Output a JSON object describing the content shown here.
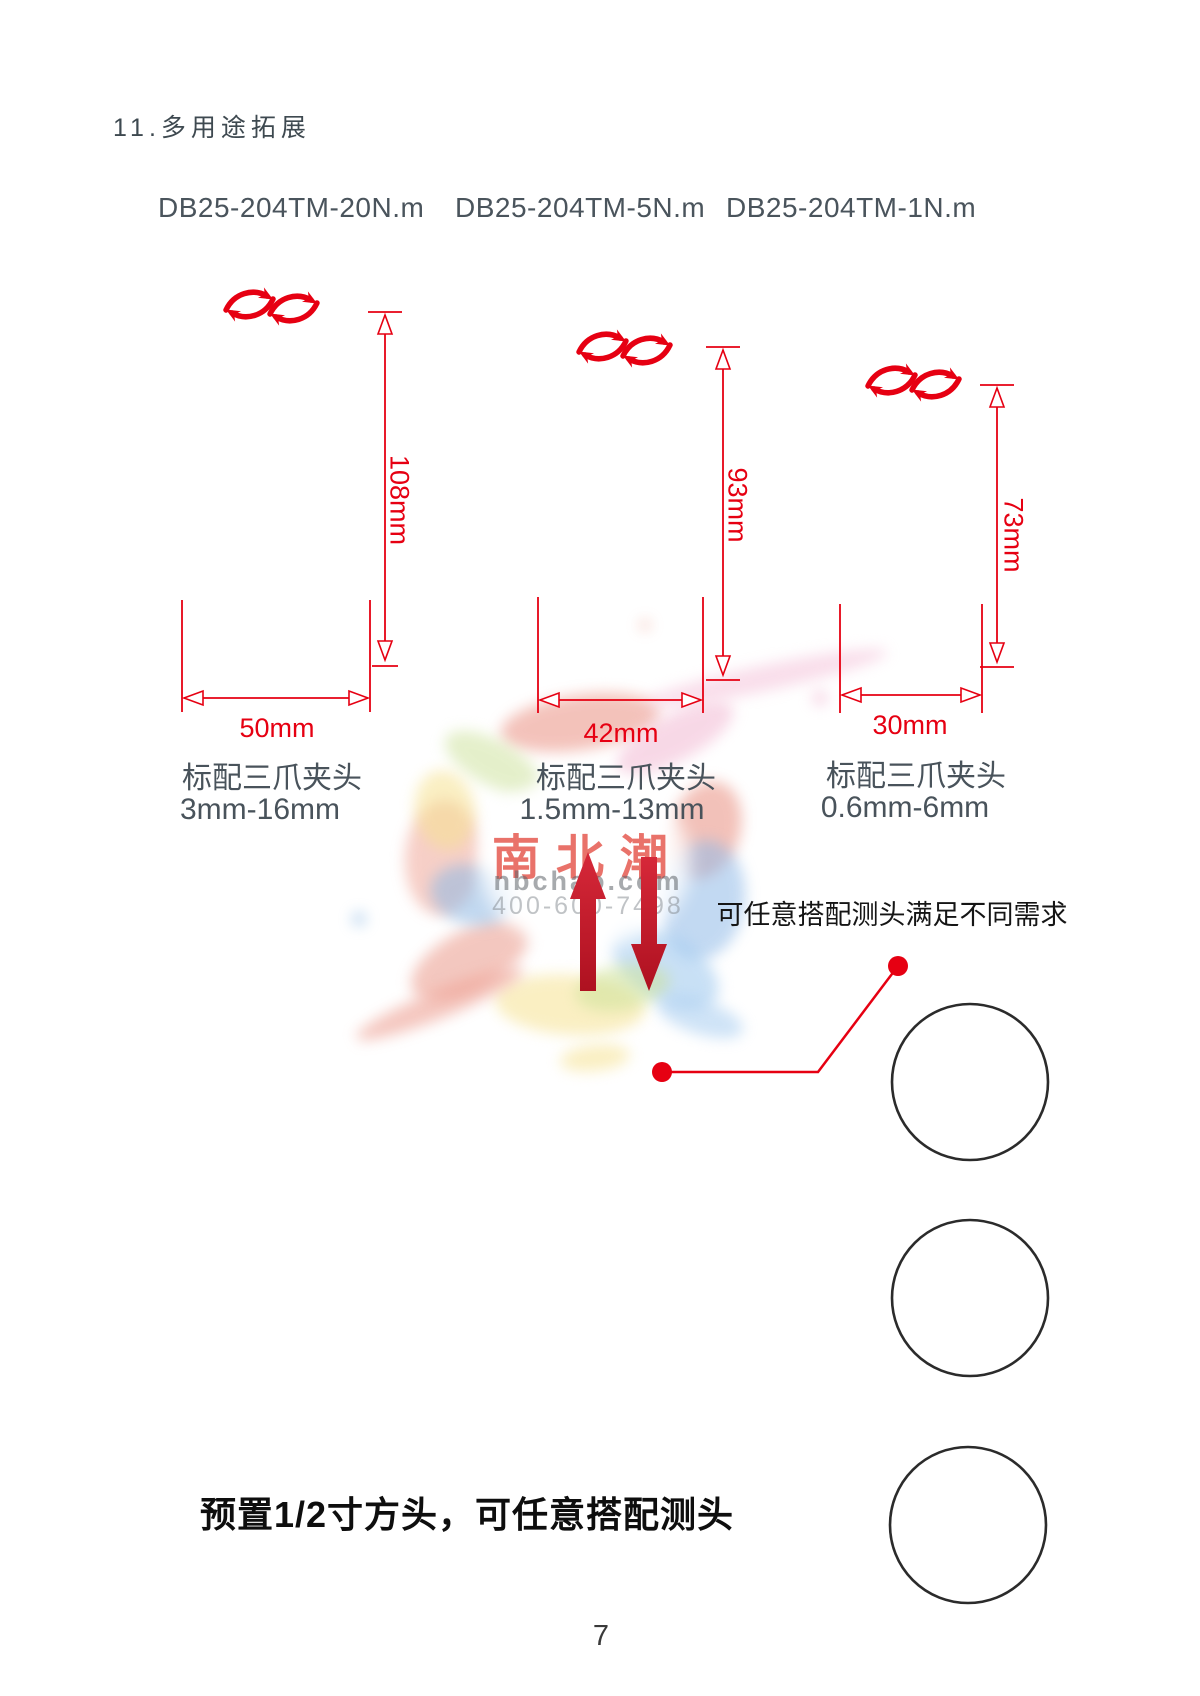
{
  "page": {
    "section_title": "11.多用途拓展",
    "probe_note": "可任意搭配测头满足不同需求",
    "footer_note": "预置1/2寸方头，可任意搭配测头",
    "page_number": "7"
  },
  "products": [
    {
      "model": "DB25-204TM-20N.m",
      "height": "108mm",
      "width": "50mm",
      "chuck_label": "标配三爪夹头",
      "chuck_range": "3mm-16mm"
    },
    {
      "model": "DB25-204TM-5N.m",
      "height": "93mm",
      "width": "42mm",
      "chuck_label": "标配三爪夹头",
      "chuck_range": "1.5mm-13mm"
    },
    {
      "model": "DB25-204TM-1N.m",
      "height": "73mm",
      "width": "30mm",
      "chuck_label": "标配三爪夹头",
      "chuck_range": "0.6mm-6mm"
    }
  ],
  "watermark": {
    "brand": "南北潮",
    "domain": "nbchao.com",
    "phone": "400-600-7498"
  },
  "icons": {
    "rotation_icon": "bidirectional-rotation-arrows",
    "pointer_icon": "red-callout-line-with-dots"
  },
  "colors": {
    "dimension_red": "#e60012",
    "arrow_crimson": "#c4172a",
    "label_gray": "#49535b",
    "circle_outline": "#2b2b2b"
  }
}
